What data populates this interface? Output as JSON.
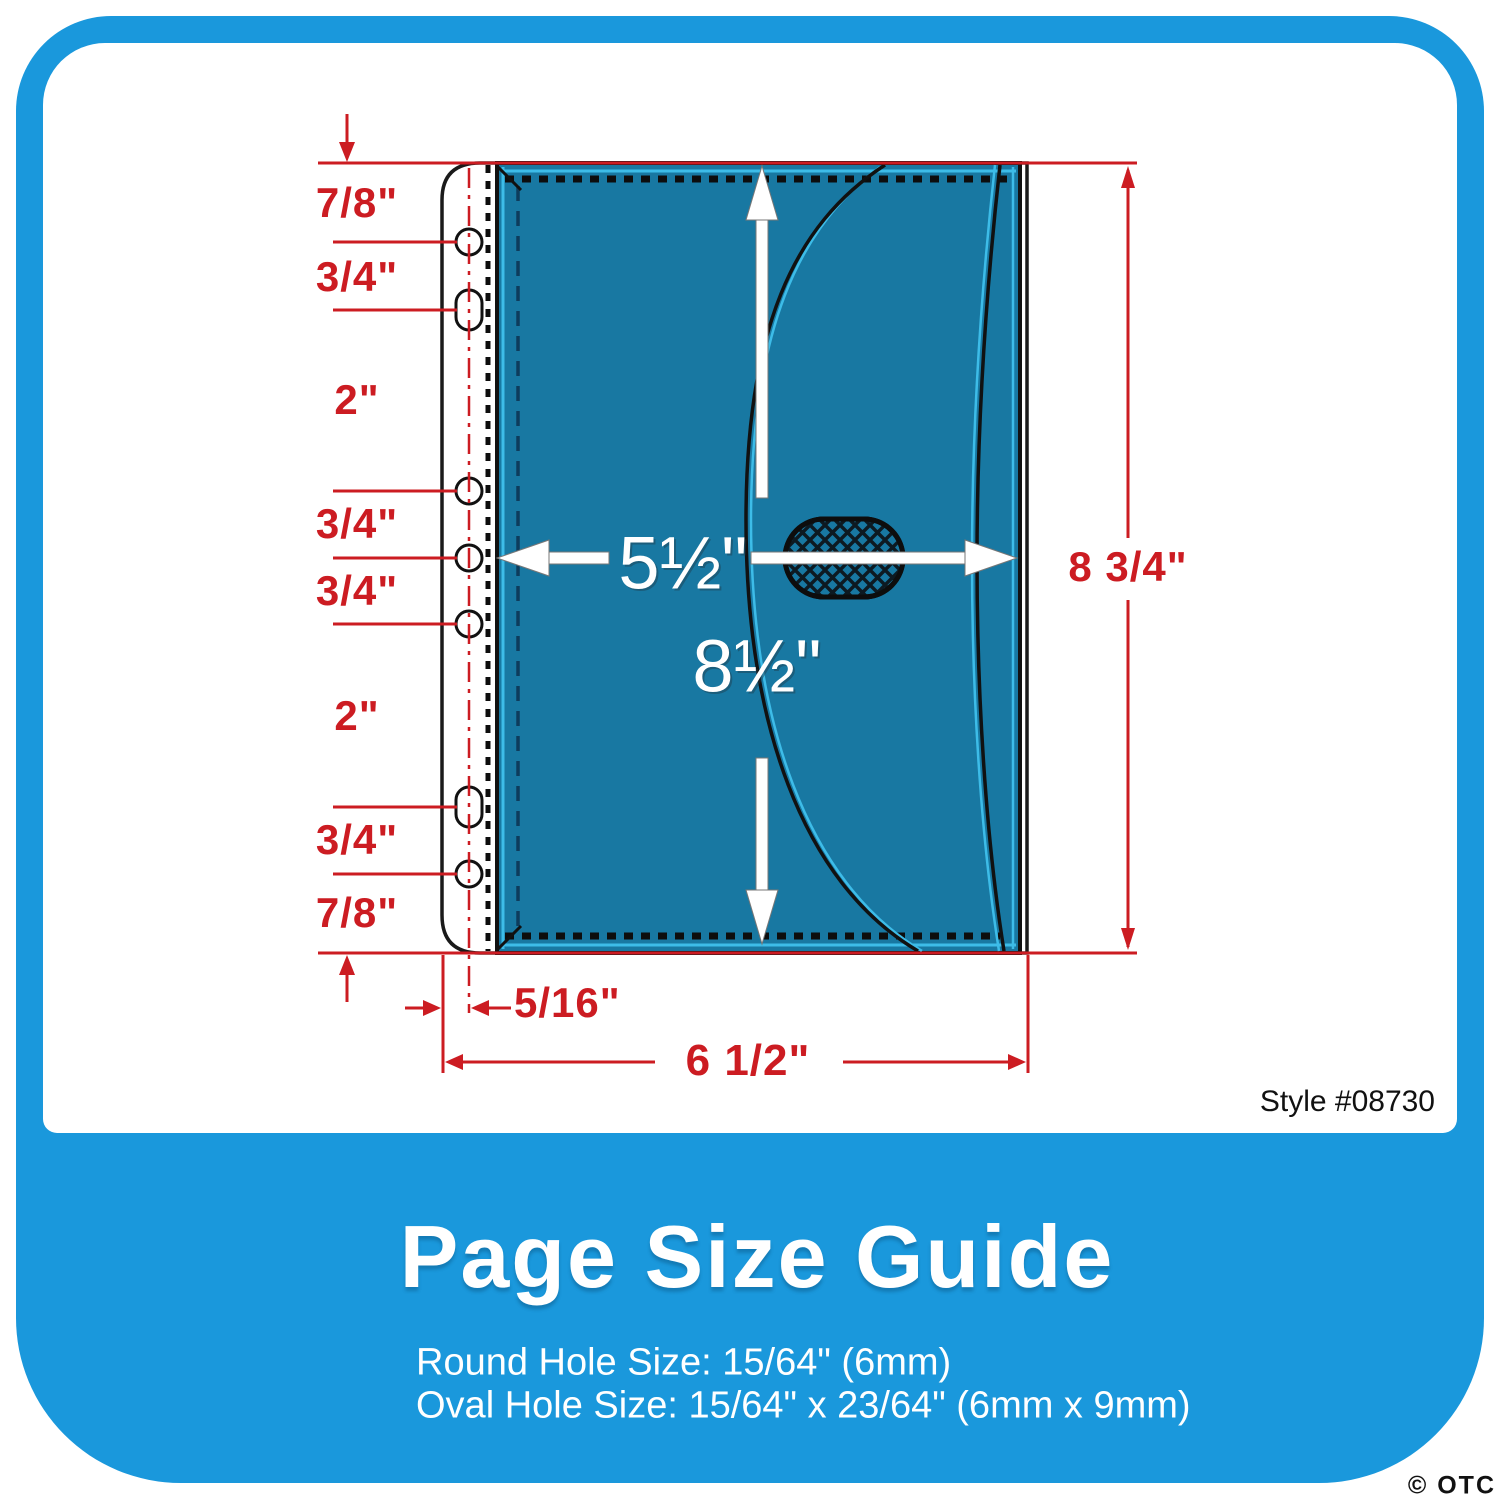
{
  "colors": {
    "frame_blue": "#1a98dc",
    "envelope_teal": "#1878a2",
    "accent_cyan": "#3dbce8",
    "dimension_red": "#cc1c22"
  },
  "diagram": {
    "hole_spacing_labels": [
      "7/8\"",
      "3/4\"",
      "2\"",
      "3/4\"",
      "3/4\"",
      "2\"",
      "3/4\"",
      "7/8\""
    ],
    "pocket_width_label": "5½\"",
    "pocket_height_label": "8½\"",
    "sheet_height_label": "8 3/4\"",
    "hole_offset_label": "5/16\"",
    "sheet_width_label": "6 1/2\"",
    "style_number": "Style #08730"
  },
  "footer": {
    "title": "Page Size Guide",
    "round_hole_size": "Round Hole Size: 15/64\" (6mm)",
    "oval_hole_size": "Oval Hole Size: 15/64\" x 23/64\" (6mm x 9mm)",
    "watermark": "© OTC"
  }
}
